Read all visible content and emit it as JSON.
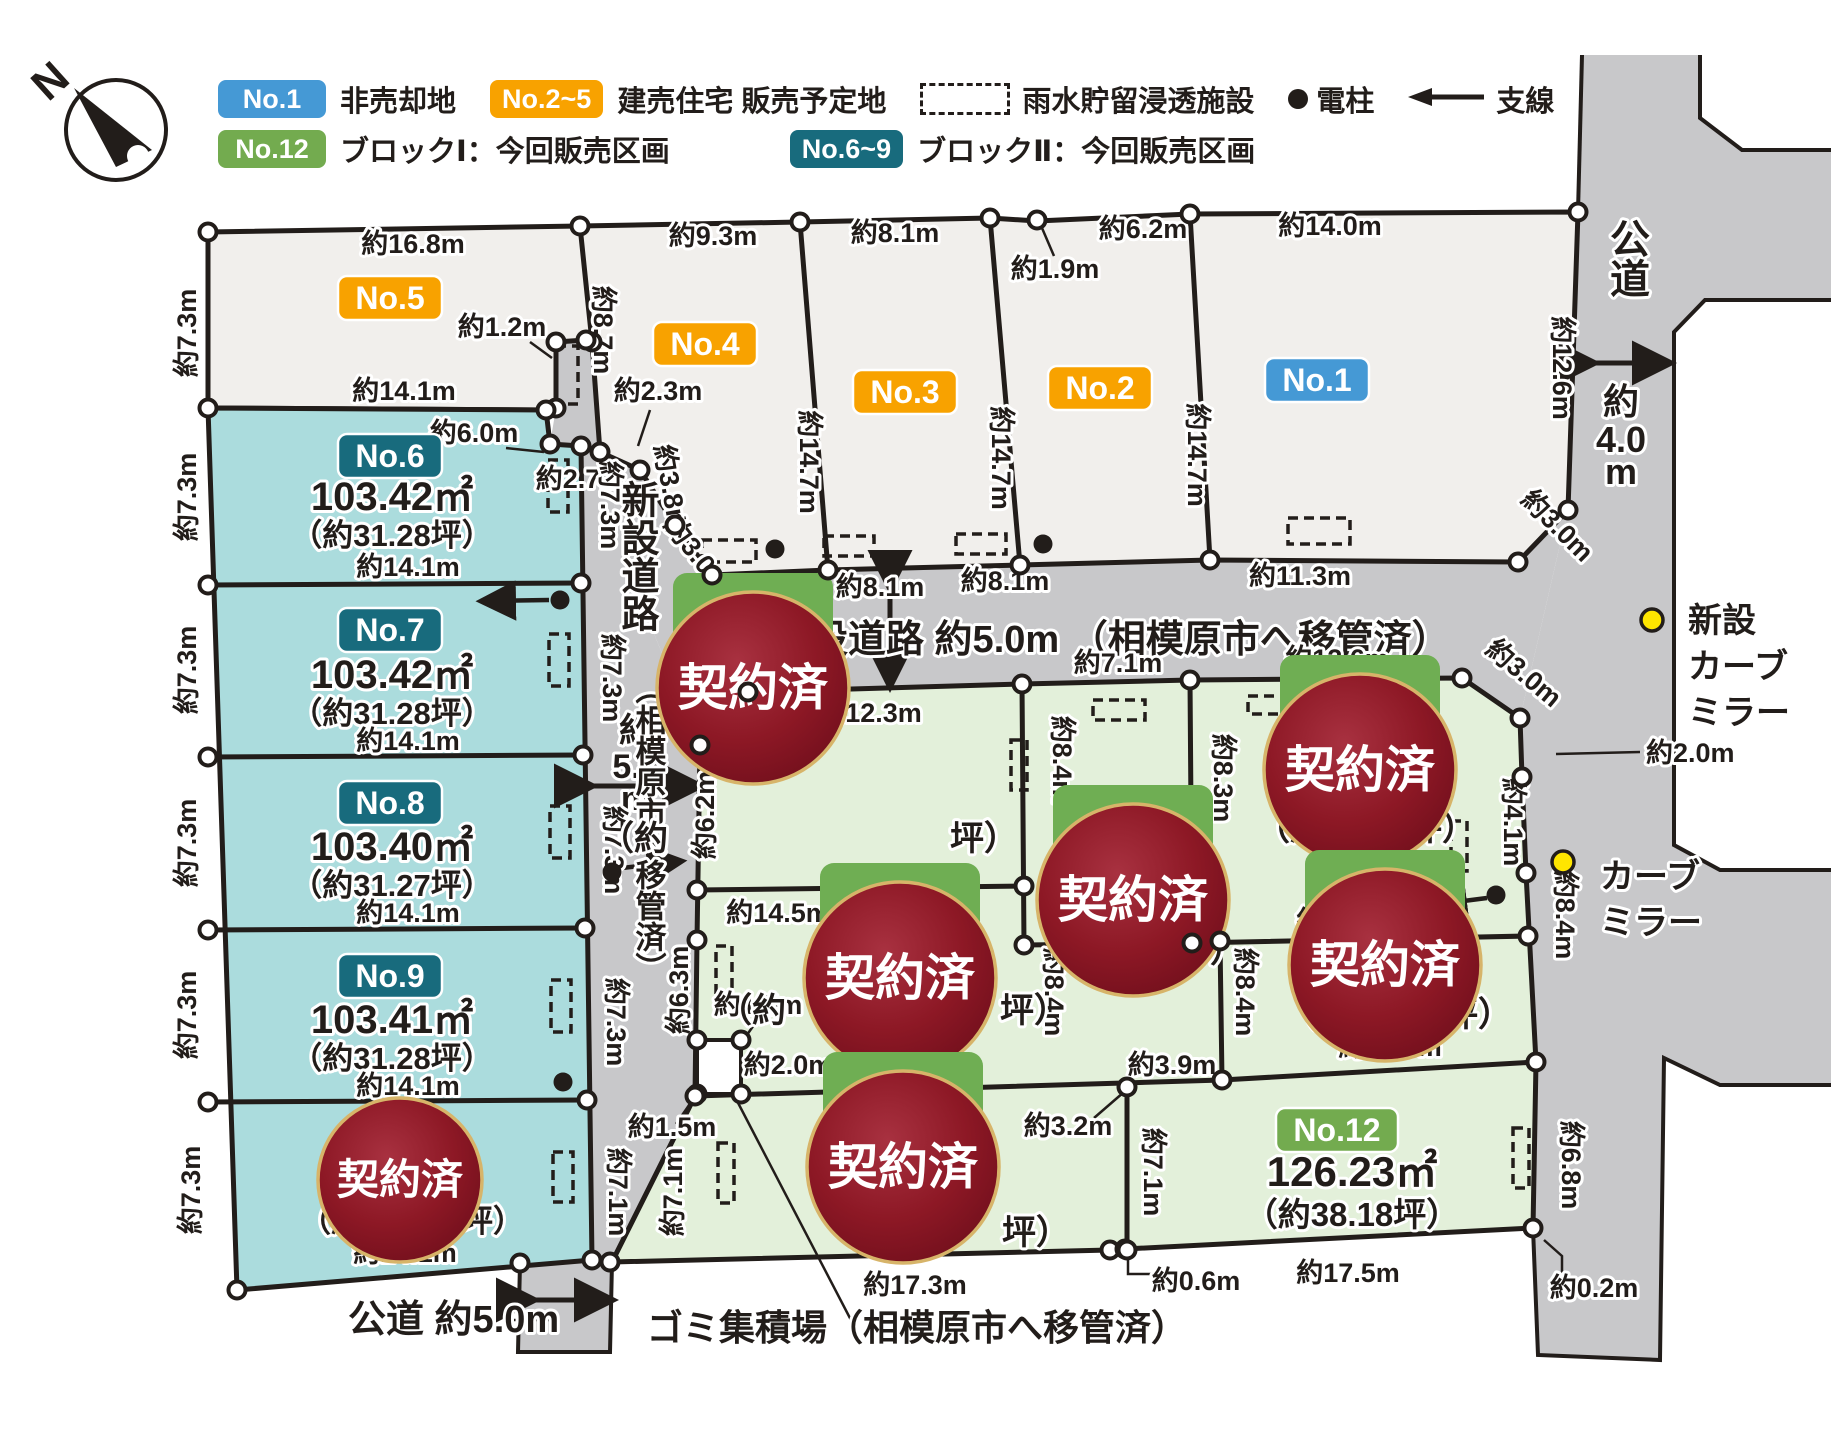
{
  "legend": {
    "row1": {
      "badge1": "No.1",
      "text1": "非売却地",
      "badge2": "No.2~5",
      "text2": "建売住宅 販売予定地",
      "text3": "雨水貯留浸透施設",
      "text4": "電柱",
      "text5": "支線"
    },
    "row2": {
      "badge1": "No.12",
      "text1": "ブロックⅠ：今回販売区画",
      "badge2": "No.6~9",
      "text2": "ブロックⅡ：今回販売区画"
    },
    "colors": {
      "blue": "#4599d5",
      "orange": "#f8a200",
      "green": "#73ab4f",
      "teal": "#186b7d"
    }
  },
  "compass": {
    "n": "N"
  },
  "lots": [
    {
      "no": "No.1",
      "type": "非売却地"
    },
    {
      "no": "No.2",
      "type": "建売住宅 販売予定地"
    },
    {
      "no": "No.3",
      "type": "建売住宅 販売予定地"
    },
    {
      "no": "No.4",
      "type": "建売住宅 販売予定地"
    },
    {
      "no": "No.5",
      "type": "建売住宅 販売予定地"
    },
    {
      "no": "No.6",
      "area": "103.42㎡",
      "tsubo": "（約31.28坪）",
      "block": "ブロックⅡ"
    },
    {
      "no": "No.7",
      "area": "103.42㎡",
      "tsubo": "（約31.28坪）",
      "block": "ブロックⅡ"
    },
    {
      "no": "No.8",
      "area": "103.40㎡",
      "tsubo": "（約31.27坪）",
      "block": "ブロックⅡ"
    },
    {
      "no": "No.9",
      "area": "103.41㎡",
      "tsubo": "（約31.28坪）",
      "block": "ブロックⅡ"
    },
    {
      "no": "No.12",
      "area": "126.23㎡",
      "tsubo": "（約38.18坪）",
      "block": "ブロックⅠ"
    },
    {
      "status": "契約済",
      "count": 7
    }
  ],
  "map": {
    "sold_label": "契約済",
    "labels": [
      {
        "t": "N",
        "x": 60,
        "y": 92,
        "r": -42,
        "s": 44
      },
      {
        "t": "約16.8m",
        "x": 413,
        "y": 253
      },
      {
        "t": "約9.3m",
        "x": 713,
        "y": 245
      },
      {
        "t": "約8.1m",
        "x": 895,
        "y": 242
      },
      {
        "t": "約6.2m",
        "x": 1143,
        "y": 238
      },
      {
        "t": "約1.9m",
        "x": 1055,
        "y": 278
      },
      {
        "t": "約14.0m",
        "x": 1330,
        "y": 235
      },
      {
        "t": "約8.7m",
        "x": 594,
        "y": 330,
        "r": 90
      },
      {
        "t": "約14.7m",
        "x": 800,
        "y": 462,
        "r": 90
      },
      {
        "t": "約14.7m",
        "x": 992,
        "y": 458,
        "r": 90
      },
      {
        "t": "約14.7m",
        "x": 1188,
        "y": 455,
        "r": 90
      },
      {
        "t": "約12.6m",
        "x": 1553,
        "y": 368,
        "r": 90
      },
      {
        "t": "公道",
        "x": 1626,
        "y": 258,
        "v": 1,
        "s": 40
      },
      {
        "t": "約",
        "x": 1621,
        "y": 414,
        "s": 36
      },
      {
        "t": "4.0",
        "x": 1621,
        "y": 452,
        "s": 36
      },
      {
        "t": "m",
        "x": 1621,
        "y": 484,
        "s": 36
      },
      {
        "t": "約4.8m",
        "x": 755,
        "y": 600
      },
      {
        "t": "約8.1m",
        "x": 880,
        "y": 596
      },
      {
        "t": "約8.1m",
        "x": 1005,
        "y": 590
      },
      {
        "t": "約11.3m",
        "x": 1300,
        "y": 585
      },
      {
        "t": "約3.0m",
        "x": 690,
        "y": 560,
        "r": 52
      },
      {
        "t": "約3.0m",
        "x": 1551,
        "y": 532,
        "r": 45
      },
      {
        "t": "約3.0m",
        "x": 712,
        "y": 704,
        "r": -48
      },
      {
        "t": "約3.0m",
        "x": 1518,
        "y": 680,
        "r": 40
      },
      {
        "t": "約1.2m",
        "x": 502,
        "y": 336
      },
      {
        "t": "約6.0m",
        "x": 474,
        "y": 442
      },
      {
        "t": "約2.7m",
        "x": 580,
        "y": 488
      },
      {
        "t": "約2.3m",
        "x": 658,
        "y": 400
      },
      {
        "t": "約3.8m",
        "x": 662,
        "y": 490,
        "r": 80
      },
      {
        "t": "新設道路 約5.0m （相模原市へ移管済）",
        "x": 772,
        "y": 652,
        "s": 38,
        "a": "s"
      },
      {
        "t": "新設道路",
        "x": 636,
        "y": 556,
        "v": 1,
        "s": 38
      },
      {
        "t": "約",
        "x": 636,
        "y": 742,
        "s": 34
      },
      {
        "t": "5.0",
        "x": 636,
        "y": 778,
        "s": 34
      },
      {
        "t": "m",
        "x": 636,
        "y": 810,
        "s": 34
      },
      {
        "t": "（相模原市へ移管済）",
        "x": 648,
        "y": 828,
        "v": 1,
        "s": 31
      },
      {
        "t": "公道 約5.0m",
        "x": 348,
        "y": 1332,
        "s": 38,
        "a": "s"
      },
      {
        "t": "ゴミ集積場（相模原市へ移管済）",
        "x": 647,
        "y": 1340,
        "s": 36,
        "a": "s"
      },
      {
        "t": "約7.3m",
        "x": 601,
        "y": 505,
        "r": 90
      },
      {
        "t": "約7.3m",
        "x": 603,
        "y": 678,
        "r": 90
      },
      {
        "t": "約7.3m",
        "x": 605,
        "y": 850,
        "r": 90
      },
      {
        "t": "約7.3m",
        "x": 607,
        "y": 1022,
        "r": 90
      },
      {
        "t": "約7.1m",
        "x": 609,
        "y": 1192,
        "r": 90
      },
      {
        "t": "約7.3m",
        "x": 196,
        "y": 333,
        "r": -90
      },
      {
        "t": "約7.3m",
        "x": 196,
        "y": 497,
        "r": -90
      },
      {
        "t": "約7.3m",
        "x": 196,
        "y": 670,
        "r": -90
      },
      {
        "t": "約7.3m",
        "x": 196,
        "y": 843,
        "r": -90
      },
      {
        "t": "約7.3m",
        "x": 196,
        "y": 1015,
        "r": -90
      },
      {
        "t": "約7.3m",
        "x": 200,
        "y": 1190,
        "r": -90
      },
      {
        "t": "約14.1m",
        "x": 404,
        "y": 400
      },
      {
        "t": "103.42㎡",
        "x": 392,
        "y": 510,
        "s": 40
      },
      {
        "t": "（約31.28坪）",
        "x": 392,
        "y": 546,
        "s": 31
      },
      {
        "t": "約14.1m",
        "x": 408,
        "y": 576
      },
      {
        "t": "103.42㎡",
        "x": 392,
        "y": 688,
        "s": 40
      },
      {
        "t": "（約31.28坪）",
        "x": 392,
        "y": 724,
        "s": 31
      },
      {
        "t": "約14.1m",
        "x": 408,
        "y": 750
      },
      {
        "t": "103.40㎡",
        "x": 392,
        "y": 860,
        "s": 40
      },
      {
        "t": "（約31.27坪）",
        "x": 392,
        "y": 896,
        "s": 31
      },
      {
        "t": "約14.1m",
        "x": 408,
        "y": 922
      },
      {
        "t": "103.41㎡",
        "x": 392,
        "y": 1033,
        "s": 40
      },
      {
        "t": "（約31.28坪）",
        "x": 392,
        "y": 1069,
        "s": 31
      },
      {
        "t": "約14.1m",
        "x": 408,
        "y": 1095
      },
      {
        "t": "約14.1m",
        "x": 405,
        "y": 1262
      },
      {
        "t": "（約",
        "x": 300,
        "y": 1232,
        "a": "s",
        "s": 31
      },
      {
        "t": "坪）",
        "x": 462,
        "y": 1232,
        "a": "s",
        "s": 31
      },
      {
        "t": "約12.3m",
        "x": 870,
        "y": 722
      },
      {
        "t": "約7.1m",
        "x": 1118,
        "y": 672
      },
      {
        "t": "約12.6m",
        "x": 1337,
        "y": 668
      },
      {
        "t": "約6.2m",
        "x": 714,
        "y": 815,
        "r": -90
      },
      {
        "t": "約8.4m",
        "x": 1053,
        "y": 760,
        "r": 90
      },
      {
        "t": "約8.3m",
        "x": 1214,
        "y": 778,
        "r": 90
      },
      {
        "t": "約4.1m",
        "x": 1504,
        "y": 822,
        "r": 90
      },
      {
        "t": "約14.5m",
        "x": 778,
        "y": 922
      },
      {
        "t": "約14.4m",
        "x": 1348,
        "y": 930
      },
      {
        "t": "約8.4m",
        "x": 1556,
        "y": 915,
        "r": 90
      },
      {
        "t": "約6.3m",
        "x": 688,
        "y": 990,
        "r": -90
      },
      {
        "t": "約8.4m",
        "x": 1045,
        "y": 992,
        "r": 90
      },
      {
        "t": "約8.4m",
        "x": 1236,
        "y": 992,
        "r": 90
      },
      {
        "t": "約2.0m",
        "x": 788,
        "y": 1074
      },
      {
        "t": "約13.1m",
        "x": 908,
        "y": 1082
      },
      {
        "t": "約3.9m",
        "x": 1172,
        "y": 1074
      },
      {
        "t": "約3.2m",
        "x": 1068,
        "y": 1135
      },
      {
        "t": "約7.1m",
        "x": 682,
        "y": 1192,
        "r": -90
      },
      {
        "t": "約7.1m",
        "x": 1144,
        "y": 1172,
        "r": 90
      },
      {
        "t": "約13.9m",
        "x": 1390,
        "y": 1056
      },
      {
        "t": "約17.3m",
        "x": 915,
        "y": 1294
      },
      {
        "t": "約0.6m",
        "x": 1196,
        "y": 1290
      },
      {
        "t": "約17.5m",
        "x": 1348,
        "y": 1282
      },
      {
        "t": "約0.2m",
        "x": 1594,
        "y": 1297
      },
      {
        "t": "約6.8m",
        "x": 1562,
        "y": 1165,
        "r": 90
      },
      {
        "t": "約2.0m",
        "x": 1646,
        "y": 762,
        "a": "s"
      },
      {
        "t": "約1.5m",
        "x": 758,
        "y": 1014
      },
      {
        "t": "約1.5m",
        "x": 672,
        "y": 1136
      },
      {
        "t": "（約",
        "x": 600,
        "y": 850,
        "a": "s",
        "s": 34
      },
      {
        "t": "坪）",
        "x": 950,
        "y": 850,
        "a": "s",
        "s": 34
      },
      {
        "t": "（約",
        "x": 1040,
        "y": 962,
        "a": "s",
        "s": 34
      },
      {
        "t": "坪）",
        "x": 1176,
        "y": 962,
        "a": "s",
        "s": 34
      },
      {
        "t": "（約",
        "x": 1256,
        "y": 840,
        "a": "s",
        "s": 34
      },
      {
        "t": "坪）",
        "x": 1408,
        "y": 840,
        "a": "s",
        "s": 34
      },
      {
        "t": "（約",
        "x": 718,
        "y": 1022,
        "a": "s",
        "s": 34
      },
      {
        "t": "坪）",
        "x": 1000,
        "y": 1022,
        "a": "s",
        "s": 34
      },
      {
        "t": "（約",
        "x": 1284,
        "y": 1026,
        "a": "s",
        "s": 34
      },
      {
        "t": "坪）",
        "x": 1444,
        "y": 1026,
        "a": "s",
        "s": 34
      },
      {
        "t": "（約",
        "x": 822,
        "y": 1244,
        "a": "s",
        "s": 34
      },
      {
        "t": "坪）",
        "x": 1002,
        "y": 1244,
        "a": "s",
        "s": 34
      },
      {
        "t": "新設",
        "x": 1688,
        "y": 632,
        "a": "s",
        "s": 34
      },
      {
        "t": "カーブ",
        "x": 1688,
        "y": 678,
        "a": "s",
        "s": 34
      },
      {
        "t": "ミラー",
        "x": 1688,
        "y": 724,
        "a": "s",
        "s": 34
      },
      {
        "t": "カーブ",
        "x": 1600,
        "y": 888,
        "a": "s",
        "s": 34
      },
      {
        "t": "ミラー",
        "x": 1600,
        "y": 934,
        "a": "s",
        "s": 34
      },
      {
        "t": "126.23㎡",
        "x": 1352,
        "y": 1186,
        "s": 42
      },
      {
        "t": "（約38.18坪）",
        "x": 1352,
        "y": 1226,
        "s": 33
      }
    ],
    "badges": [
      {
        "t": "No.5",
        "x": 390,
        "y": 298,
        "c": "#f8a200"
      },
      {
        "t": "No.4",
        "x": 705,
        "y": 344,
        "c": "#f8a200"
      },
      {
        "t": "No.3",
        "x": 905,
        "y": 392,
        "c": "#f8a200"
      },
      {
        "t": "No.2",
        "x": 1100,
        "y": 388,
        "c": "#f8a200"
      },
      {
        "t": "No.1",
        "x": 1317,
        "y": 380,
        "c": "#4599d5"
      },
      {
        "t": "No.6",
        "x": 390,
        "y": 456,
        "c": "#186b7d"
      },
      {
        "t": "No.7",
        "x": 390,
        "y": 630,
        "c": "#186b7d"
      },
      {
        "t": "No.8",
        "x": 390,
        "y": 803,
        "c": "#186b7d"
      },
      {
        "t": "No.9",
        "x": 390,
        "y": 976,
        "c": "#186b7d"
      },
      {
        "t": "No.12",
        "x": 1337,
        "y": 1130,
        "c": "#73ab4f",
        "w": 122
      }
    ],
    "sold": [
      {
        "x": 400,
        "y": 1180,
        "r": 82,
        "house": 0
      },
      {
        "x": 753,
        "y": 688,
        "r": 96,
        "house": 1
      },
      {
        "x": 1133,
        "y": 900,
        "r": 96,
        "house": 1
      },
      {
        "x": 1360,
        "y": 770,
        "r": 96,
        "house": 1
      },
      {
        "x": 900,
        "y": 978,
        "r": 96,
        "house": 1
      },
      {
        "x": 1385,
        "y": 965,
        "r": 96,
        "house": 1
      },
      {
        "x": 903,
        "y": 1167,
        "r": 96,
        "house": 1
      }
    ],
    "dashed": [
      {
        "x": 556,
        "y": 346,
        "w": 22,
        "h": 58
      },
      {
        "x": 548,
        "y": 460,
        "w": 20,
        "h": 52
      },
      {
        "x": 549,
        "y": 634,
        "w": 20,
        "h": 52
      },
      {
        "x": 550,
        "y": 806,
        "w": 20,
        "h": 52
      },
      {
        "x": 551,
        "y": 980,
        "w": 20,
        "h": 52
      },
      {
        "x": 553,
        "y": 1152,
        "w": 20,
        "h": 50
      },
      {
        "x": 702,
        "y": 540,
        "w": 54,
        "h": 22
      },
      {
        "x": 824,
        "y": 536,
        "w": 50,
        "h": 20
      },
      {
        "x": 956,
        "y": 534,
        "w": 50,
        "h": 20
      },
      {
        "x": 1288,
        "y": 518,
        "w": 62,
        "h": 26
      },
      {
        "x": 1011,
        "y": 740,
        "w": 16,
        "h": 50
      },
      {
        "x": 1093,
        "y": 700,
        "w": 52,
        "h": 20
      },
      {
        "x": 1248,
        "y": 696,
        "w": 46,
        "h": 18
      },
      {
        "x": 716,
        "y": 946,
        "w": 16,
        "h": 48
      },
      {
        "x": 718,
        "y": 1143,
        "w": 16,
        "h": 60
      },
      {
        "x": 1451,
        "y": 821,
        "w": 16,
        "h": 50
      },
      {
        "x": 1513,
        "y": 1128,
        "w": 16,
        "h": 60
      }
    ],
    "vertices": [
      [
        208,
        232
      ],
      [
        580,
        226
      ],
      [
        800,
        222
      ],
      [
        990,
        218
      ],
      [
        1037,
        220
      ],
      [
        1190,
        214
      ],
      [
        1578,
        212
      ],
      [
        1568,
        510
      ],
      [
        1518,
        562
      ],
      [
        1210,
        560
      ],
      [
        1020,
        565
      ],
      [
        828,
        570
      ],
      [
        712,
        575
      ],
      [
        675,
        525
      ],
      [
        640,
        470
      ],
      [
        600,
        452
      ],
      [
        592,
        342
      ],
      [
        586,
        340
      ],
      [
        556,
        342
      ],
      [
        556,
        408
      ],
      [
        546,
        410
      ],
      [
        550,
        444
      ],
      [
        581,
        446
      ],
      [
        208,
        408
      ],
      [
        208,
        585
      ],
      [
        581,
        583
      ],
      [
        208,
        757
      ],
      [
        583,
        755
      ],
      [
        208,
        930
      ],
      [
        585,
        928
      ],
      [
        208,
        1102
      ],
      [
        587,
        1100
      ],
      [
        237,
        1290
      ],
      [
        592,
        1260
      ],
      [
        520,
        1263
      ],
      [
        610,
        1262
      ],
      [
        748,
        692
      ],
      [
        700,
        745
      ],
      [
        1022,
        684
      ],
      [
        1190,
        680
      ],
      [
        1462,
        678
      ],
      [
        1520,
        718
      ],
      [
        1522,
        777
      ],
      [
        1526,
        873
      ],
      [
        697,
        890
      ],
      [
        1024,
        886
      ],
      [
        1024,
        945
      ],
      [
        1192,
        943
      ],
      [
        1220,
        941
      ],
      [
        1528,
        936
      ],
      [
        697,
        940
      ],
      [
        697,
        1040
      ],
      [
        741,
        1040
      ],
      [
        697,
        1094
      ],
      [
        741,
        1094
      ],
      [
        695,
        1096
      ],
      [
        1222,
        1080
      ],
      [
        1127,
        1087
      ],
      [
        1536,
        1062
      ],
      [
        1110,
        1250
      ],
      [
        1125,
        1249
      ],
      [
        1533,
        1228
      ],
      [
        1127,
        1250
      ]
    ],
    "poles": [
      [
        775,
        549
      ],
      [
        1043,
        544
      ],
      [
        560,
        600
      ],
      [
        563,
        1082
      ],
      [
        612,
        872
      ],
      [
        1496,
        895
      ]
    ],
    "mirrors": [
      [
        1652,
        620
      ],
      [
        1563,
        862
      ]
    ],
    "dim_arrows": [
      [
        890,
        580,
        890,
        678
      ],
      [
        584,
        786,
        692,
        786
      ],
      [
        526,
        1300,
        604,
        1300
      ],
      [
        1586,
        363,
        1662,
        363
      ]
    ],
    "pole_arrows": [
      [
        549,
        600,
        489,
        601
      ],
      [
        622,
        868,
        674,
        862
      ],
      [
        1487,
        898,
        1440,
        904
      ]
    ],
    "leaders": [
      [
        1042,
        228,
        1054,
        256
      ],
      [
        530,
        342,
        552,
        358
      ],
      [
        506,
        448,
        544,
        452
      ],
      [
        650,
        410,
        638,
        446
      ],
      [
        1640,
        752,
        1556,
        754
      ],
      [
        1094,
        1118,
        1124,
        1092
      ],
      [
        735,
        1097,
        852,
        1322
      ],
      [
        508,
        1320,
        558,
        1320
      ],
      [
        1128,
        1254,
        1128,
        1274,
        1152,
        1274
      ],
      [
        1544,
        1240,
        1562,
        1256,
        1562,
        1276
      ],
      [
        756,
        1022,
        742,
        1042
      ],
      [
        676,
        1124,
        694,
        1098
      ]
    ]
  }
}
